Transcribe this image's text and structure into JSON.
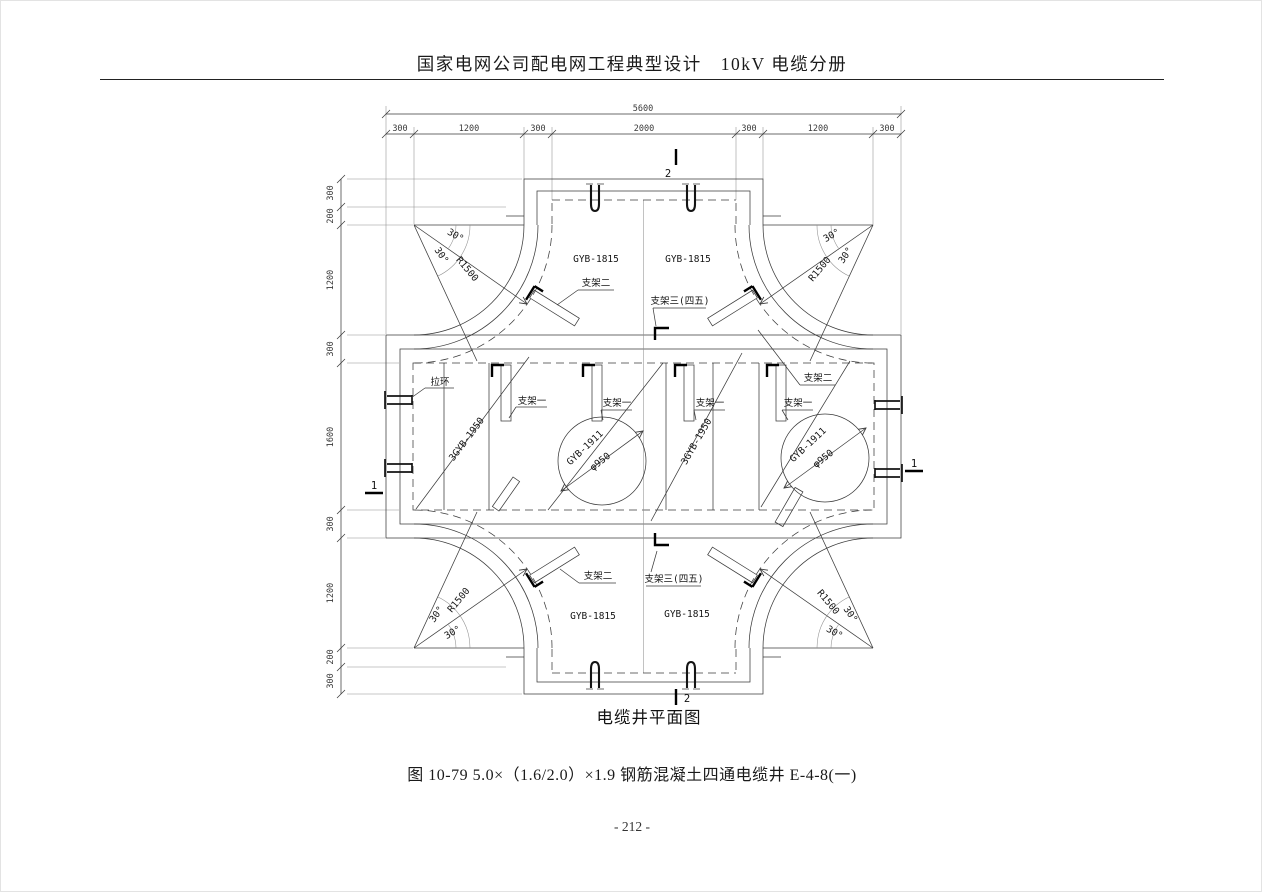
{
  "header": {
    "title": "国家电网公司配电网工程典型设计　10kV 电缆分册"
  },
  "drawing": {
    "caption": "电缆井平面图",
    "dims": {
      "overall_width": "5600",
      "top_segments": [
        "300",
        "1200",
        "300",
        "2000",
        "300",
        "1200",
        "300"
      ],
      "left_segments": [
        "300",
        "200",
        "1200",
        "300",
        "1600",
        "300",
        "1200",
        "200",
        "300"
      ]
    },
    "labels": {
      "cover_side": "GYB-1815",
      "bracket_1": "支架一",
      "bracket_2": "支架二",
      "bracket_3": "支架三(四五)",
      "pull_ring": "拉环",
      "cover_group": "3GYB-1950",
      "cover_round": "GYB-1911",
      "manhole_dia": "φ950",
      "radius": "R1500",
      "angle": "30°",
      "section_1": "1",
      "section_2": "2"
    }
  },
  "figure_caption": "图 10-79 5.0×（1.6/2.0）×1.9 钢筋混凝土四通电缆井 E-4-8(一)",
  "page_number": "- 212 -"
}
